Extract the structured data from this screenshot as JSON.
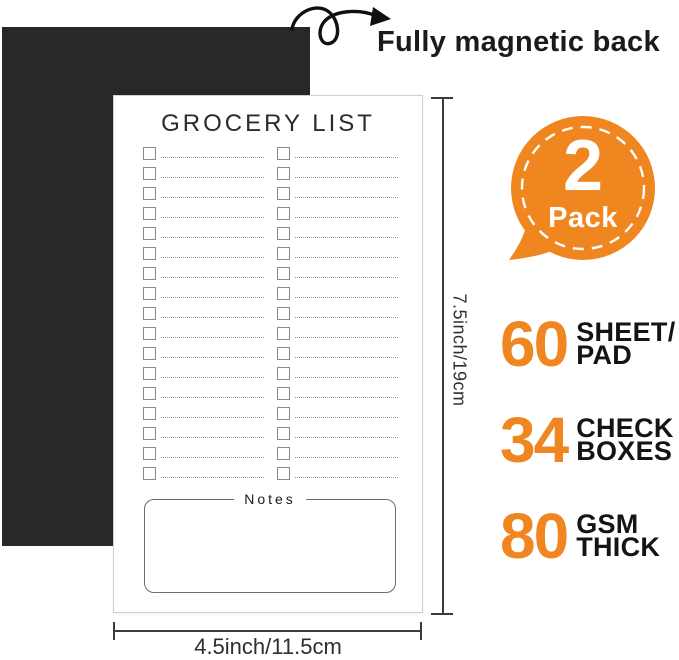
{
  "header": {
    "caption": "Fully magnetic back"
  },
  "notepad": {
    "title": "GROCERY LIST",
    "columns": 2,
    "rows_per_column": 17,
    "notes_label": "Notes"
  },
  "badge": {
    "number": "2",
    "label": "Pack"
  },
  "dimensions": {
    "height_label": "7.5inch/19cm",
    "width_label": "4.5inch/11.5cm"
  },
  "specs": [
    {
      "value": "60",
      "label_line1": "SHEET/",
      "label_line2": "PAD"
    },
    {
      "value": "34",
      "label_line1": "CHECK",
      "label_line2": "BOXES"
    },
    {
      "value": "80",
      "label_line1": "GSM",
      "label_line2": "THICK"
    }
  ],
  "colors": {
    "accent_orange": "#F0861F",
    "magnet_black": "#282828"
  }
}
